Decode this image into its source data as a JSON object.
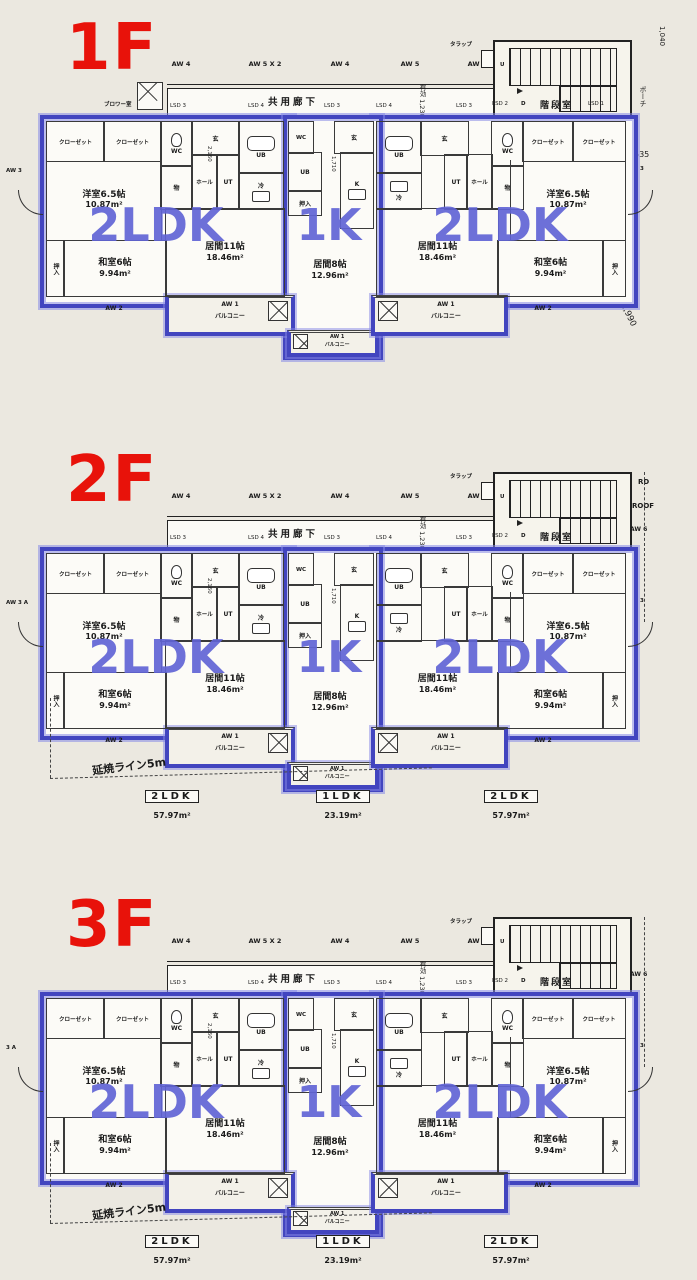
{
  "document_type": "apartment-floor-plan-drawing",
  "colors": {
    "paper": "#ebe8e0",
    "floor_label_red": "#e8120a",
    "unit_outline_blue": "#4245bf",
    "unit_text_blue": "#6164d5",
    "line_black": "#222222"
  },
  "floors": [
    {
      "label": "1F",
      "left_label": "AW 3",
      "right_label": "AW 3",
      "aw_top": [
        "AW 4",
        "AW 5 X 2",
        "AW 4",
        "AW 5",
        "AW 4"
      ],
      "corridor_label": "共用廊下",
      "lsd": [
        "LSD 3",
        "LSD 4",
        "LSD 3",
        "LSD 4",
        "LSD 3"
      ],
      "eff_label": "有効 1,230",
      "trap_label": "タラップ",
      "stair": {
        "name": "階段室",
        "lsd2": "LSD 2",
        "d": "D",
        "u": "U",
        "lsd1": "LSD 1"
      },
      "extras": {
        "blower": "ブロワー室",
        "porch": "ポーチ",
        "d1040": "1,040",
        "d665": "665",
        "d535": "535",
        "d2990": "2,990"
      },
      "lower": null,
      "units": {
        "left": {
          "type": "2LDK",
          "rooms": {
            "closet1": "クローゼット",
            "closet2": "クローゼット",
            "wc": "WC",
            "gen": "玄",
            "ub": "UB",
            "mono": "物",
            "hall": "ホール",
            "ut": "UT",
            "rei": "冷",
            "dim": "2,160",
            "yoshitsu": "洋室6.5帖",
            "yoshitsu_area": "10.87m²",
            "washitsu": "和室6帖",
            "washitsu_area": "9.94m²",
            "ima": "居間11帖",
            "ima_area": "18.46m²",
            "oshiire": "押入"
          },
          "balcony": "バルコニー",
          "aw1": "AW 1",
          "aw2": "AW 2"
        },
        "middle": {
          "type": "1K",
          "rooms": {
            "wc": "WC",
            "gen": "玄",
            "ub": "UB",
            "k": "K",
            "dim": "1,710",
            "oshiire": "押入",
            "ima": "居間8帖",
            "ima_area": "12.96m²"
          },
          "balcony": "バルコニー",
          "aw1": "AW 1"
        },
        "right": {
          "type": "2LDK",
          "rooms": {
            "closet1": "クローゼット",
            "closet2": "クローゼット",
            "wc": "WC",
            "gen": "玄",
            "ub": "UB",
            "mono": "物",
            "hall": "ホール",
            "ut": "UT",
            "rei": "冷",
            "dim": "2,160",
            "yoshitsu": "洋室6.5帖",
            "yoshitsu_area": "10.87m²",
            "washitsu": "和室6帖",
            "washitsu_area": "9.94m²",
            "ima": "居間11帖",
            "ima_area": "18.46m²",
            "oshiire": "押入"
          },
          "balcony": "バルコニー",
          "aw1": "AW 1",
          "aw2": "AW 2"
        }
      }
    },
    {
      "label": "2F",
      "left_label": "AW 3 A",
      "right_label": "AW 3",
      "aw_top": [
        "AW 4",
        "AW 5 X 2",
        "AW 4",
        "AW 5",
        "AW 4"
      ],
      "corridor_label": "共用廊下",
      "lsd": [
        "LSD 3",
        "LSD 4",
        "LSD 3",
        "LSD 4",
        "LSD 3"
      ],
      "eff_label": "有効 1,230",
      "trap_label": "タラップ",
      "stair": {
        "name": "階段室",
        "lsd2": "LSD 2",
        "d": "D",
        "u": "U"
      },
      "extras": {
        "rd": "RD",
        "roof": "ROOF",
        "aw6": "AW 6"
      },
      "lower": {
        "ember": "延焼ライン5m",
        "summary": [
          {
            "type": "2LDK",
            "area": "57.97m²"
          },
          {
            "type": "1LDK",
            "area": "23.19m²"
          },
          {
            "type": "2LDK",
            "area": "57.97m²"
          }
        ]
      },
      "units": {
        "left": {
          "type": "2LDK",
          "rooms": {
            "closet1": "クローゼット",
            "closet2": "クローゼット",
            "wc": "WC",
            "gen": "玄",
            "ub": "UB",
            "mono": "物",
            "hall": "ホール",
            "ut": "UT",
            "rei": "冷",
            "dim": "2,160",
            "yoshitsu": "洋室6.5帖",
            "yoshitsu_area": "10.87m²",
            "washitsu": "和室6帖",
            "washitsu_area": "9.94m²",
            "ima": "居間11帖",
            "ima_area": "18.46m²",
            "oshiire": "押入"
          },
          "balcony": "バルコニー",
          "aw1": "AW 1",
          "aw2": "AW 2"
        },
        "middle": {
          "type": "1K",
          "rooms": {
            "wc": "WC",
            "gen": "玄",
            "ub": "UB",
            "k": "K",
            "dim": "1,710",
            "oshiire": "押入",
            "ima": "居間8帖",
            "ima_area": "12.96m²"
          },
          "balcony": "バルコニー",
          "aw1": "AW 1"
        },
        "right": {
          "type": "2LDK",
          "rooms": {
            "closet1": "クローゼット",
            "closet2": "クローゼット",
            "wc": "WC",
            "gen": "玄",
            "ub": "UB",
            "mono": "物",
            "hall": "ホール",
            "ut": "UT",
            "rei": "冷",
            "dim": "2,160",
            "yoshitsu": "洋室6.5帖",
            "yoshitsu_area": "10.87m²",
            "washitsu": "和室6帖",
            "washitsu_area": "9.94m²",
            "ima": "居間11帖",
            "ima_area": "18.46m²",
            "oshiire": "押入"
          },
          "balcony": "バルコニー",
          "aw1": "AW 1",
          "aw2": "AW 2"
        }
      }
    },
    {
      "label": "3F",
      "left_label": "3 A",
      "right_label": "AW 3",
      "aw_top": [
        "AW 4",
        "AW 5 X 2",
        "AW 4",
        "AW 5",
        "AW 4"
      ],
      "corridor_label": "共用廊下",
      "lsd": [
        "LSD 3",
        "LSD 4",
        "LSD 3",
        "LSD 4",
        "LSD 3"
      ],
      "eff_label": "有効 1,230",
      "trap_label": "タラップ",
      "stair": {
        "name": "階段室",
        "lsd2": "LSD 2",
        "d": "D",
        "u": "U"
      },
      "extras": {
        "aw6": "AW 6"
      },
      "lower": {
        "ember": "延焼ライン5m",
        "summary": [
          {
            "type": "2LDK",
            "area": "57.97m²"
          },
          {
            "type": "1LDK",
            "area": "23.19m²"
          },
          {
            "type": "2LDK",
            "area": "57.97m²"
          }
        ]
      },
      "units": {
        "left": {
          "type": "2LDK",
          "rooms": {
            "closet1": "クローゼット",
            "closet2": "クローゼット",
            "wc": "WC",
            "gen": "玄",
            "ub": "UB",
            "mono": "物",
            "hall": "ホール",
            "ut": "UT",
            "rei": "冷",
            "dim": "2,160",
            "yoshitsu": "洋室6.5帖",
            "yoshitsu_area": "10.87m²",
            "washitsu": "和室6帖",
            "washitsu_area": "9.94m²",
            "ima": "居間11帖",
            "ima_area": "18.46m²",
            "oshiire": "押入"
          },
          "balcony": "バルコニー",
          "aw1": "AW 1",
          "aw2": "AW 2"
        },
        "middle": {
          "type": "1K",
          "rooms": {
            "wc": "WC",
            "gen": "玄",
            "ub": "UB",
            "k": "K",
            "dim": "1,710",
            "oshiire": "押入",
            "ima": "居間8帖",
            "ima_area": "12.96m²"
          },
          "balcony": "バルコニー",
          "aw1": "AW 1"
        },
        "right": {
          "type": "2LDK",
          "rooms": {
            "closet1": "クローゼット",
            "closet2": "クローゼット",
            "wc": "WC",
            "gen": "玄",
            "ub": "UB",
            "mono": "物",
            "hall": "ホール",
            "ut": "UT",
            "rei": "冷",
            "dim": "2,160",
            "yoshitsu": "洋室6.5帖",
            "yoshitsu_area": "10.87m²",
            "washitsu": "和室6帖",
            "washitsu_area": "9.94m²",
            "ima": "居間11帖",
            "ima_area": "18.46m²",
            "oshiire": "押入"
          },
          "balcony": "バルコニー",
          "aw1": "AW 1",
          "aw2": "AW 2"
        }
      }
    }
  ]
}
